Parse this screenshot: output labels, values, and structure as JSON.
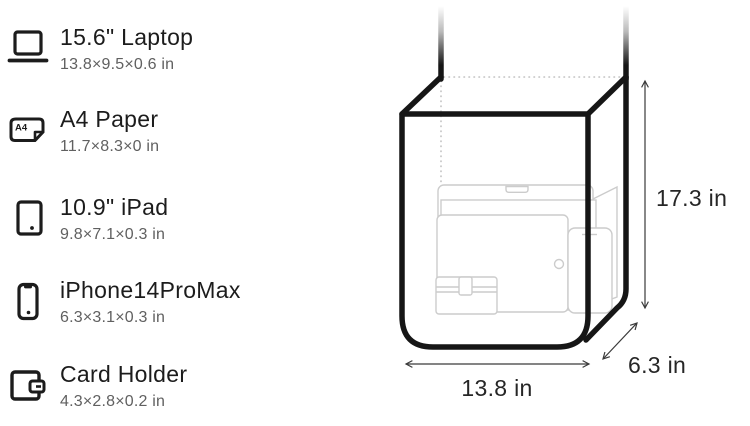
{
  "colors": {
    "background": "#ffffff",
    "text_primary": "#1c1c1c",
    "text_secondary": "#606060",
    "icon_ink": "#1c1c1c",
    "bag_outline": "#161616",
    "item_outline": "#cccccc",
    "dotted_line": "#c0c0c0",
    "dimension_line": "#3a3a3a",
    "watermark": "#d8d8d8"
  },
  "fit_items": [
    {
      "icon": "laptop-icon",
      "name": "15.6\" Laptop",
      "dimensions": "13.8×9.5×0.6 in"
    },
    {
      "icon": "a4-paper-icon",
      "name": "A4 Paper",
      "dimensions": "11.7×8.3×0 in",
      "icon_label": "A4"
    },
    {
      "icon": "ipad-icon",
      "name": "10.9\" iPad",
      "dimensions": "9.8×7.1×0.3 in"
    },
    {
      "icon": "iphone-icon",
      "name": "iPhone14ProMax",
      "dimensions": "6.3×3.1×0.3 in"
    },
    {
      "icon": "card-holder-icon",
      "name": "Card Holder",
      "dimensions": "4.3×2.8×0.2 in"
    }
  ],
  "bag_diagram": {
    "height_label": "17.3 in",
    "width_label": "13.8 in",
    "depth_label": "6.3 in",
    "paper_watermark": "A4"
  }
}
